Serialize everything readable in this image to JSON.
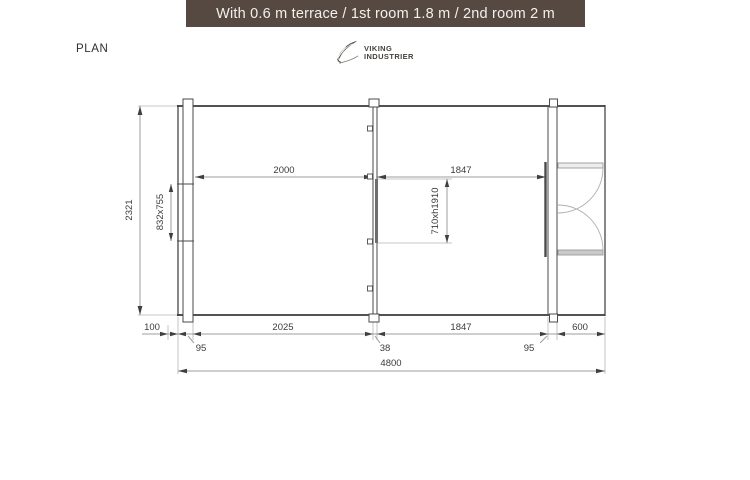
{
  "title_bar": {
    "text": "With 0.6 m terrace  / 1st room 1.8 m / 2nd room 2 m",
    "bg_color": "#564941",
    "text_color": "#f3f0ec"
  },
  "plan_label": "PLAN",
  "logo": {
    "name_line1": "VIKING",
    "name_line2": "INDUSTRIER",
    "icon": "feather-icon",
    "color": "#4a4642"
  },
  "drawing": {
    "dims": {
      "overall_width": "4800",
      "overall_depth": "2321",
      "room1_interior_width": "2000",
      "room2_interior_width": "1847",
      "window_size": "832x755",
      "door_size": "710xh1910",
      "roof_overhang": "100",
      "left_wall_thickness": "95",
      "room1_width": "2025",
      "middle_wall_thickness": "38",
      "room2_width": "1847",
      "right_wall_thickness": "95",
      "terrace_depth": "600"
    },
    "colors": {
      "outline": "#3a3a3a",
      "wall_line": "#4a4a4a",
      "dim_line": "#9c9c9c",
      "dim_text": "#3b3b3b"
    }
  }
}
